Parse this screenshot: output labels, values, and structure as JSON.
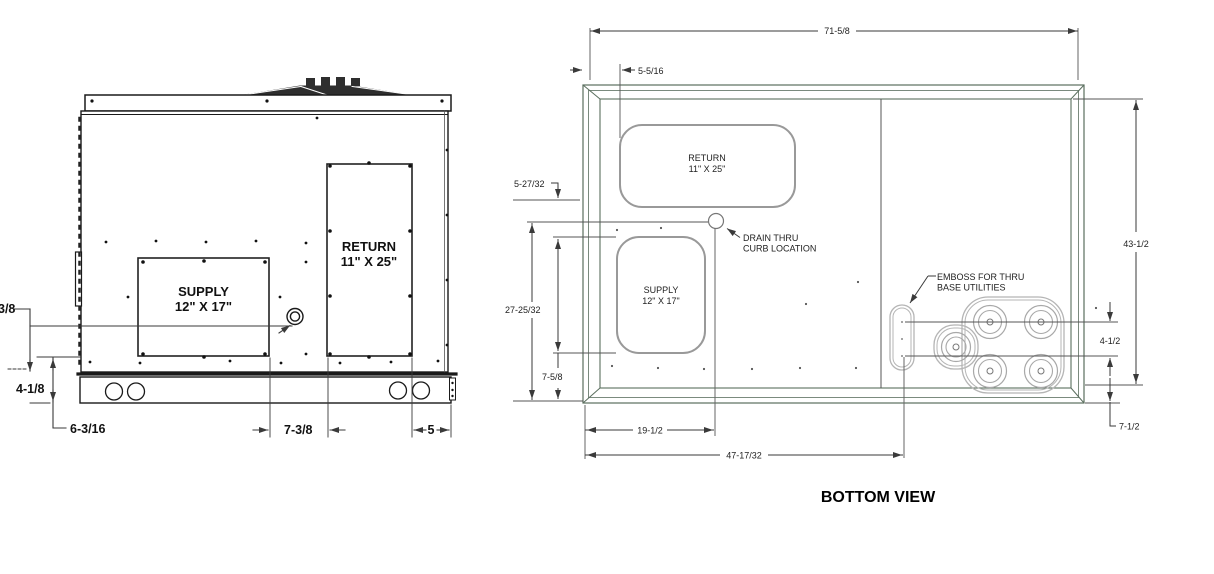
{
  "side_view": {
    "supply_line1": "SUPPLY",
    "supply_line2": "12\" X 17\"",
    "return_line1": "RETURN",
    "return_line2": "11\" X 25\"",
    "dim_partial": "3/8",
    "dim_base": "4-1/8",
    "dim_left": "6-3/16",
    "dim_gap": "7-3/8",
    "dim_right": "5"
  },
  "bottom_view": {
    "title": "BOTTOM VIEW",
    "return_line1": "RETURN",
    "return_line2": "11\" X 25\"",
    "supply_line1": "SUPPLY",
    "supply_line2": "12\" X 17\"",
    "drain_line1": "DRAIN THRU",
    "drain_line2": "CURB LOCATION",
    "emboss_line1": "EMBOSS FOR THRU",
    "emboss_line2": "BASE UTILITIES",
    "dim_width": "71-5/8",
    "dim_return_off": "5-5/16",
    "dim_drain_off": "5-27/32",
    "dim_drain_h": "27-25/32",
    "dim_supply_bot": "7-5/8",
    "dim_drain_x": "19-1/2",
    "dim_utility_x": "47-17/32",
    "dim_depth": "43-1/2",
    "dim_util_sp": "4-1/2",
    "dim_util_bot": "7-1/2"
  },
  "colors": {
    "line_dark": "#1a1a1a",
    "dim_line": "#3a3a3a",
    "pan_line": "#5a6e5e",
    "duct_line": "#999999",
    "emboss_line": "#b5b5b5"
  }
}
